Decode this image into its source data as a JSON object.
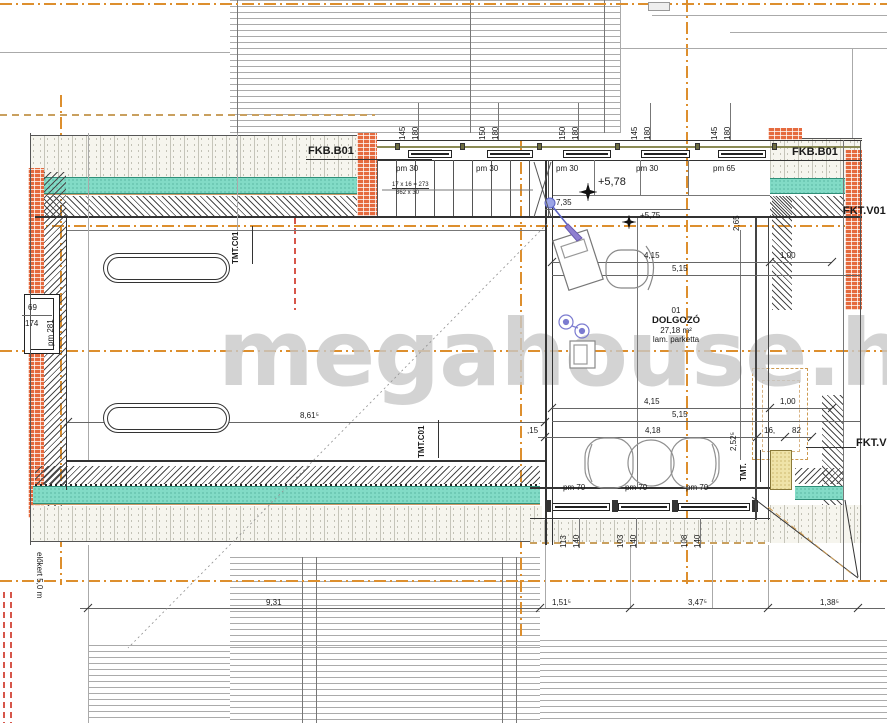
{
  "watermark": "megahouse.hu",
  "labels": {
    "fkb_left": "FKB.B01",
    "fkb_right": "FKB.B01",
    "fkt_top": "FKT.V01",
    "fkt_bottom": "FKT.V01",
    "tmt_c01_a": "TMT.C01",
    "tmt_c01_b": "TMT.C01",
    "tmt_short": "TMT.",
    "elokert": "előkert 5,0 m"
  },
  "room": {
    "number": "01",
    "name": "DOLGOZÓ",
    "area": "27,18 m²",
    "floor": "lam. parketta"
  },
  "levels": {
    "upper": "+5,78",
    "lower": "+5,75"
  },
  "stair": {
    "note1": "17 x 16 = 273",
    "note2": "862 x 30"
  },
  "pm": {
    "top": [
      "pm 30",
      "pm 30",
      "pm 30",
      "pm 30",
      "pm 65"
    ],
    "bottom": [
      "pm 70",
      "pm 70",
      "pm 70"
    ],
    "left": "pm 281"
  },
  "window_left": {
    "w": "69",
    "h": "174"
  },
  "dim_pairs_top": [
    [
      "145",
      "180"
    ],
    [
      "150",
      "180"
    ],
    [
      "150",
      "180"
    ],
    [
      "145",
      "180"
    ],
    [
      "145",
      "180"
    ]
  ],
  "dim_pairs_bottom": [
    [
      "113",
      "140"
    ],
    [
      "103",
      "140"
    ],
    [
      "108",
      "140"
    ]
  ],
  "dims": {
    "d735": "7,35",
    "d415": "4,15",
    "d515": "5,15",
    "d100": "1,00",
    "d861": "8,61⁵",
    "d418": "4,18",
    "d15": ",15",
    "d16": "16,",
    "d82": "82",
    "v265": "2,65",
    "v252": "2,52⁵",
    "b931": "9,31",
    "b151": "1,51⁵",
    "b347": "3,47⁵",
    "b138": "1,38⁵"
  }
}
